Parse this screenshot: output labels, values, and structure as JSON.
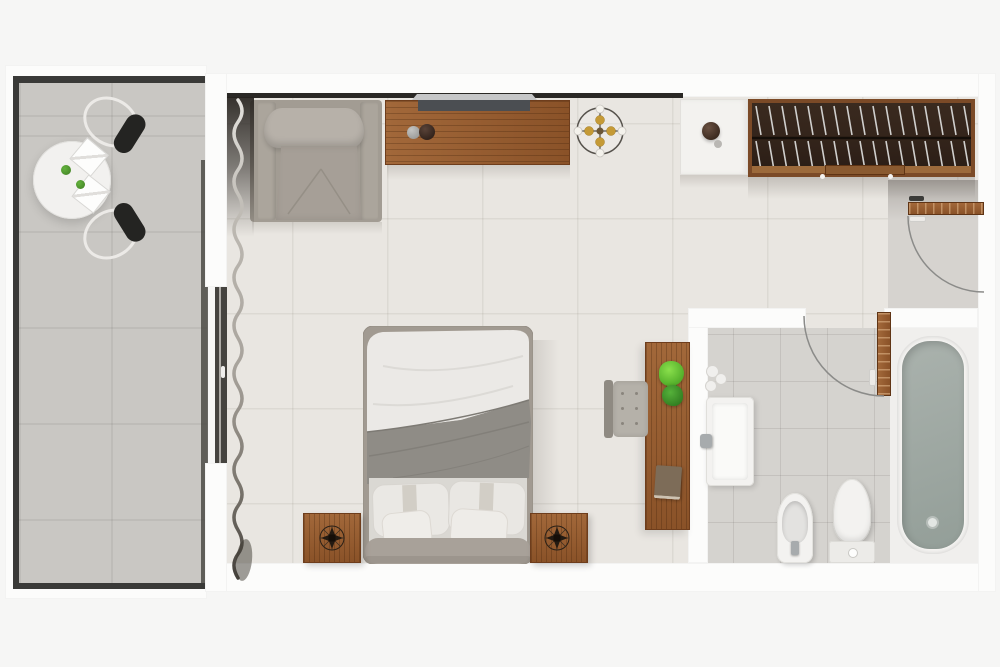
{
  "title": "Studio apartment floor plan - top-down 3D render",
  "canvas": {
    "width": 1000,
    "height": 667
  },
  "rooms": [
    {
      "id": "room-balcony",
      "label": "Balcony with round dining table and two chairs"
    },
    {
      "id": "room-main",
      "label": "Bedroom and living area"
    },
    {
      "id": "room-bathroom",
      "label": "Bathroom with bathtub, toilet, bidet and sink"
    },
    {
      "id": "room-entry",
      "label": "Entry vestibule"
    }
  ],
  "furniture": [
    {
      "id": "dining-table",
      "label": "Round white dining table with two folded napkins and greenery"
    },
    {
      "id": "balcony-chair-top",
      "label": "Balcony chair with black cushion"
    },
    {
      "id": "balcony-chair-bottom",
      "label": "Balcony chair with black cushion"
    },
    {
      "id": "sliding-window",
      "label": "Sliding glass balcony door"
    },
    {
      "id": "curtain",
      "label": "Sheer floor-length curtain"
    },
    {
      "id": "lounge-armchair",
      "label": "Gray upholstered lounge armchair"
    },
    {
      "id": "tv-console",
      "label": "Wooden media console"
    },
    {
      "id": "tv",
      "label": "Flat-screen television leaning on wall"
    },
    {
      "id": "ceiling-light",
      "label": "Round ceiling light fixture with four bulbs"
    },
    {
      "id": "minibar-cabinet",
      "label": "White minibar cabinet with decorative bowl"
    },
    {
      "id": "wardrobe",
      "label": "Dark wood open wardrobe with clothes hangers"
    },
    {
      "id": "entry-door",
      "label": "Entry door shown open with swing arc"
    },
    {
      "id": "bathroom-door",
      "label": "Bathroom door shown open with swing arc"
    },
    {
      "id": "double-bed",
      "label": "Double bed with white sheet, gray duvet and four pillows"
    },
    {
      "id": "nightstand-left",
      "label": "Wooden nightstand with compass decor"
    },
    {
      "id": "nightstand-right",
      "label": "Wooden nightstand with compass decor"
    },
    {
      "id": "desk",
      "label": "Wooden desk with two plants and a book"
    },
    {
      "id": "desk-chair",
      "label": "Tufted gray desk chair"
    },
    {
      "id": "sink-vanity",
      "label": "Wall-mounted bathroom sink"
    },
    {
      "id": "towel-rolls",
      "label": "Rolled towels"
    },
    {
      "id": "bidet",
      "label": "Bidet"
    },
    {
      "id": "toilet",
      "label": "Toilet with closed lid"
    },
    {
      "id": "bathtub",
      "label": "Bathtub filled with water"
    }
  ],
  "palette": {
    "page_bg": "#f6f6f5",
    "wall": "#fcfcfb",
    "trim_dark": "#2a2825",
    "room_floor": "#e9e6e1",
    "balcony_floor": "#c9c7c3",
    "bath_floor": "#d5d3cf",
    "wood": "#8a5228",
    "wood_light": "#a2683a",
    "wood_frame": "#7b4a27",
    "wardrobe_dark": "#32231a",
    "fabric_gray": "#a9a399",
    "linen_white": "#eceae6",
    "duvet_gray": "#8e8b85",
    "headboard": "#a8a199",
    "water": "#9ba59f",
    "plant_green": "#57b32e",
    "seat_black": "#242422",
    "chrome": "#a7abad",
    "arc_line": "#8b8b89",
    "fixture_white": "#f3f2f0",
    "glass_dark": "#45433f",
    "hanger_silver": "#d0cfcd"
  }
}
